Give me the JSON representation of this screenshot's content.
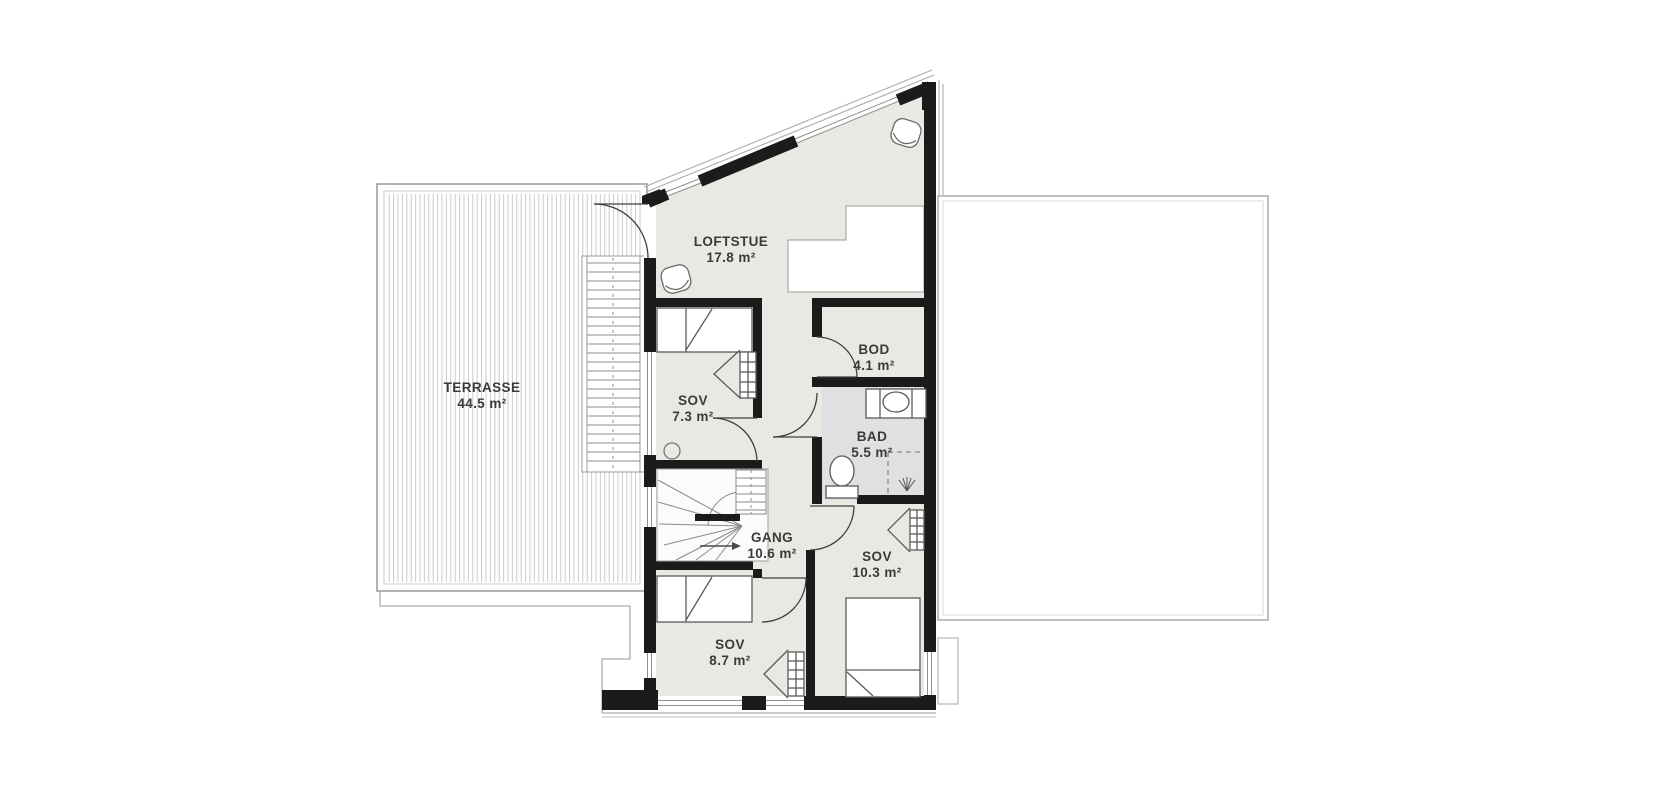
{
  "floorplan": {
    "title": "Loft floor plan",
    "rooms": [
      {
        "name": "TERRASSE",
        "area": "44.5 m²"
      },
      {
        "name": "LOFTSTUE",
        "area": "17.8 m²"
      },
      {
        "name": "SOV",
        "area": "7.3 m²"
      },
      {
        "name": "BOD",
        "area": "4.1 m²"
      },
      {
        "name": "BAD",
        "area": "5.5 m²"
      },
      {
        "name": "GANG",
        "area": "10.6 m²"
      },
      {
        "name": "SOV",
        "area": "10.3 m²"
      },
      {
        "name": "SOV",
        "area": "8.7 m²"
      }
    ],
    "colors": {
      "wall": "#1b1b1b",
      "room_floor": "#e9e9e4",
      "bathroom_floor": "#e0e0e3",
      "terrace_hatch": "#cbcbcb",
      "roof_outline": "#adadad",
      "label_text": "#3a3a3a"
    }
  }
}
